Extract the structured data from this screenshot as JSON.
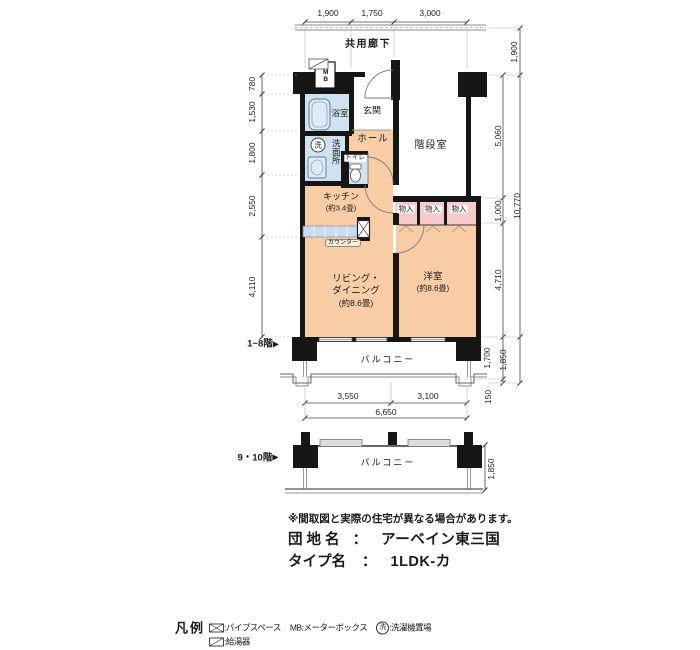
{
  "corridor_label": "共用廊下",
  "rooms": {
    "genkan": "玄関",
    "hall": "ホール",
    "bath": "浴室",
    "washroom": "洗面所",
    "washer_mark": "洗",
    "toilet": "トイレ",
    "stairs": "階段室",
    "mb": "MB",
    "kitchen": {
      "name": "キッチン",
      "size": "(約3.4畳)"
    },
    "counter": "カウンター",
    "closet": "物入",
    "living": {
      "name1": "リビング・",
      "name2": "ダイニング",
      "size": "(約8.6畳)"
    },
    "bedroom": {
      "name": "洋室",
      "size": "(約8.6畳)"
    },
    "balcony": "バルコニー"
  },
  "floors": {
    "low": "1~8階",
    "high": "9・10階",
    "arrow": "▶"
  },
  "dims": {
    "top": [
      "1,900",
      "1,750",
      "3,000"
    ],
    "left": [
      "780",
      "1,530",
      "1,800",
      "2,550",
      "4,110"
    ],
    "right_inner": [
      "5,060",
      "1,000",
      "4,710",
      "1,700",
      "150"
    ],
    "right_outer": [
      "1,900",
      "10,770",
      "1,850"
    ],
    "bottom": [
      "3,550",
      "3,100",
      "6,650"
    ],
    "balcony_high": "1,850"
  },
  "note": "※間取図と実際の住宅が異なる場合があります。",
  "estate": {
    "label": "団 地 名",
    "sep": "：",
    "value": "アーベイン東三国"
  },
  "type": {
    "label": "タイプ名",
    "sep": "：",
    "value": "1LDK-カ"
  },
  "legend": {
    "title": "凡例",
    "pipe_space": ":パイプスペース",
    "mb": "MB:メーターボックス",
    "washer_symbol": "洗",
    "washer": ":洗濯機置場",
    "heater": ":給湯器"
  },
  "colors": {
    "room_peach": "#f8cda6",
    "wet_blue": "#cfe2f2",
    "closet_pink": "#f6caca",
    "wall": "#161616"
  }
}
